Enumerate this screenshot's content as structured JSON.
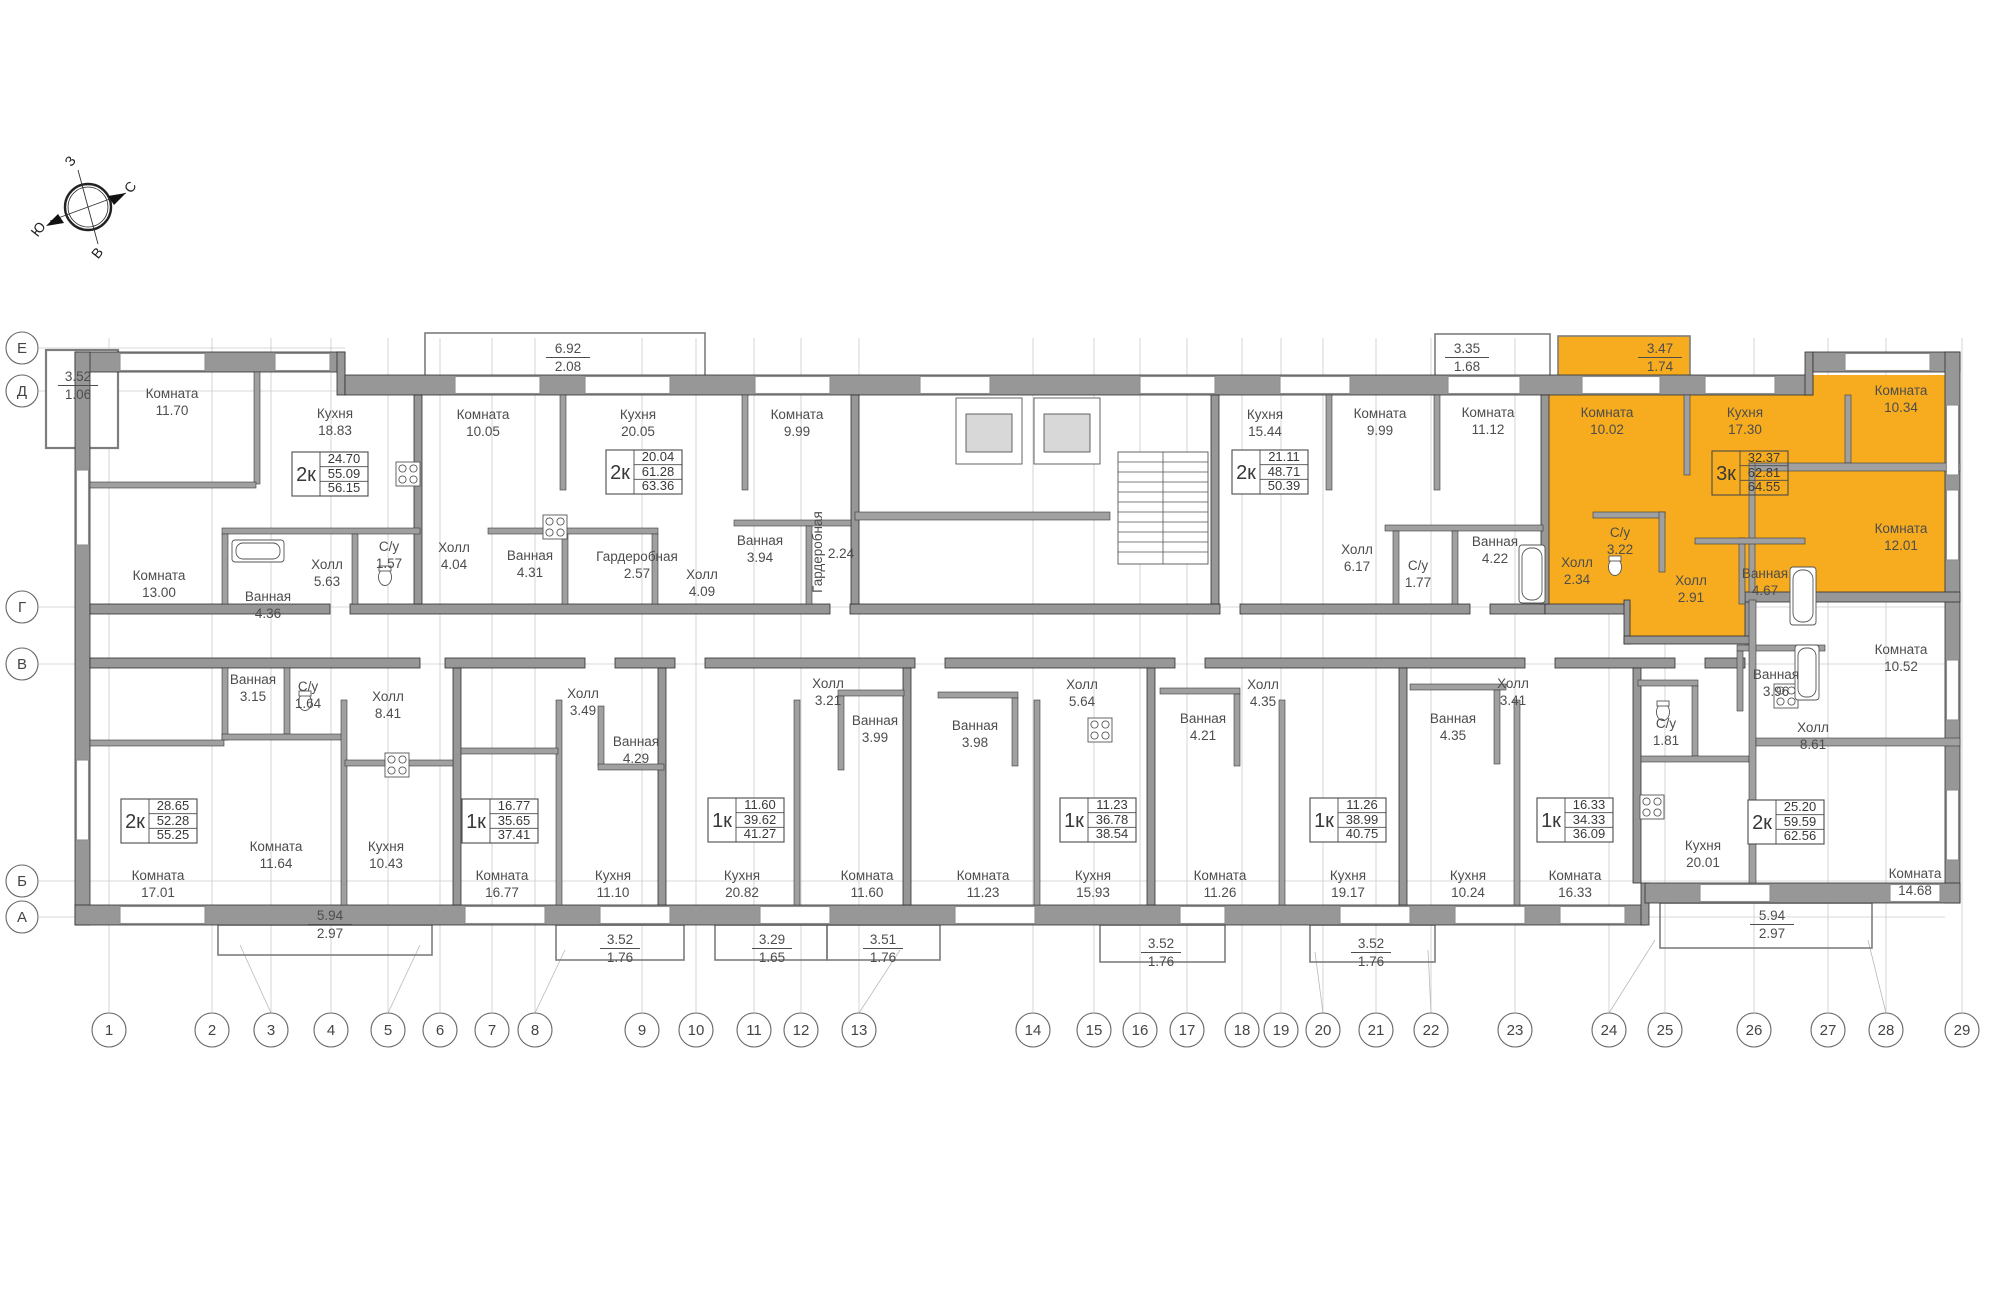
{
  "compass": {
    "top": "З",
    "right": "С",
    "bottom": "В",
    "left": "Ю"
  },
  "highlight": {
    "color": "#F6AC1E",
    "apartment_type": "3к"
  },
  "row_axes": [
    {
      "label": "Е"
    },
    {
      "label": "Д"
    },
    {
      "label": "Г"
    },
    {
      "label": "В"
    },
    {
      "label": "Б"
    },
    {
      "label": "А"
    }
  ],
  "column_axes": [
    {
      "label": "1"
    },
    {
      "label": "2"
    },
    {
      "label": "3"
    },
    {
      "label": "4"
    },
    {
      "label": "5"
    },
    {
      "label": "6"
    },
    {
      "label": "7"
    },
    {
      "label": "8"
    },
    {
      "label": "9"
    },
    {
      "label": "10"
    },
    {
      "label": "11"
    },
    {
      "label": "12"
    },
    {
      "label": "13"
    },
    {
      "label": "14"
    },
    {
      "label": "15"
    },
    {
      "label": "16"
    },
    {
      "label": "17"
    },
    {
      "label": "18"
    },
    {
      "label": "19"
    },
    {
      "label": "20"
    },
    {
      "label": "21"
    },
    {
      "label": "22"
    },
    {
      "label": "23"
    },
    {
      "label": "24"
    },
    {
      "label": "25"
    },
    {
      "label": "26"
    },
    {
      "label": "27"
    },
    {
      "label": "28"
    },
    {
      "label": "29"
    }
  ],
  "apartments": [
    {
      "type": "2к",
      "living_area": "24.70",
      "apartment_area": "55.09",
      "total_area": "56.15",
      "highlighted": false,
      "rooms": [
        {
          "name": "Комната",
          "area": "11.70"
        },
        {
          "name": "Кухня",
          "area": "18.83"
        },
        {
          "name": "Комната",
          "area": "13.00"
        },
        {
          "name": "Ванная",
          "area": "4.36"
        },
        {
          "name": "Холл",
          "area": "5.63"
        },
        {
          "name": "С/у",
          "area": "1.57"
        }
      ]
    },
    {
      "type": "2к",
      "living_area": "20.04",
      "apartment_area": "61.28",
      "total_area": "63.36",
      "highlighted": false,
      "rooms": [
        {
          "name": "Комната",
          "area": "10.05"
        },
        {
          "name": "Кухня",
          "area": "20.05"
        },
        {
          "name": "Комната",
          "area": "9.99"
        },
        {
          "name": "Холл",
          "area": "4.04"
        },
        {
          "name": "Ванная",
          "area": "4.31"
        },
        {
          "name": "Гардеробная",
          "area": "2.57"
        },
        {
          "name": "Холл",
          "area": "4.09"
        },
        {
          "name": "Ванная",
          "area": "3.94"
        },
        {
          "name": "Гардеробная",
          "area": "2.24"
        }
      ]
    },
    {
      "type": "2к",
      "living_area": "21.11",
      "apartment_area": "48.71",
      "total_area": "50.39",
      "highlighted": false,
      "rooms": [
        {
          "name": "Кухня",
          "area": "15.44"
        },
        {
          "name": "Комната",
          "area": "9.99"
        },
        {
          "name": "Комната",
          "area": "11.12"
        },
        {
          "name": "Холл",
          "area": "6.17"
        },
        {
          "name": "С/у",
          "area": "1.77"
        },
        {
          "name": "Ванная",
          "area": "4.22"
        }
      ]
    },
    {
      "type": "3к",
      "living_area": "32.37",
      "apartment_area": "62.81",
      "total_area": "64.55",
      "highlighted": true,
      "rooms": [
        {
          "name": "Комната",
          "area": "10.02"
        },
        {
          "name": "Кухня",
          "area": "17.30"
        },
        {
          "name": "Комната",
          "area": "10.34"
        },
        {
          "name": "Комната",
          "area": "12.01"
        },
        {
          "name": "Холл",
          "area": "2.34"
        },
        {
          "name": "С/у",
          "area": "3.22"
        },
        {
          "name": "Холл",
          "area": "2.91"
        },
        {
          "name": "Ванная",
          "area": "4.67"
        }
      ]
    },
    {
      "type": "2к",
      "living_area": "28.65",
      "apartment_area": "52.28",
      "total_area": "55.25",
      "highlighted": false,
      "rooms": [
        {
          "name": "Комната",
          "area": "17.01"
        },
        {
          "name": "Комната",
          "area": "11.64"
        },
        {
          "name": "Кухня",
          "area": "10.43"
        },
        {
          "name": "Ванная",
          "area": "3.15"
        },
        {
          "name": "С/у",
          "area": "1.64"
        },
        {
          "name": "Холл",
          "area": "8.41"
        }
      ]
    },
    {
      "type": "1к",
      "living_area": "16.77",
      "apartment_area": "35.65",
      "total_area": "37.41",
      "highlighted": false,
      "rooms": [
        {
          "name": "Комната",
          "area": "16.77"
        },
        {
          "name": "Кухня",
          "area": "11.10"
        },
        {
          "name": "Холл",
          "area": "3.49"
        },
        {
          "name": "Ванная",
          "area": "4.29"
        }
      ]
    },
    {
      "type": "1к",
      "living_area": "11.60",
      "apartment_area": "39.62",
      "total_area": "41.27",
      "highlighted": false,
      "rooms": [
        {
          "name": "Кухня",
          "area": "20.82"
        },
        {
          "name": "Комната",
          "area": "11.60"
        },
        {
          "name": "Холл",
          "area": "3.21"
        },
        {
          "name": "Ванная",
          "area": "3.99"
        }
      ]
    },
    {
      "type": "1к",
      "living_area": "11.23",
      "apartment_area": "36.78",
      "total_area": "38.54",
      "highlighted": false,
      "rooms": [
        {
          "name": "Комната",
          "area": "11.23"
        },
        {
          "name": "Кухня",
          "area": "15.93"
        },
        {
          "name": "Холл",
          "area": "5.64"
        },
        {
          "name": "Ванная",
          "area": "3.98"
        }
      ]
    },
    {
      "type": "1к",
      "living_area": "11.26",
      "apartment_area": "38.99",
      "total_area": "40.75",
      "highlighted": false,
      "rooms": [
        {
          "name": "Кухня",
          "area": "19.17"
        },
        {
          "name": "Комната",
          "area": "11.26"
        },
        {
          "name": "Холл",
          "area": "4.35"
        },
        {
          "name": "Ванная",
          "area": "4.21"
        }
      ]
    },
    {
      "type": "1к",
      "living_area": "16.33",
      "apartment_area": "34.33",
      "total_area": "36.09",
      "highlighted": false,
      "rooms": [
        {
          "name": "Кухня",
          "area": "10.24"
        },
        {
          "name": "Комната",
          "area": "16.33"
        },
        {
          "name": "Холл",
          "area": "3.41"
        },
        {
          "name": "Ванная",
          "area": "4.35"
        }
      ]
    },
    {
      "type": "2к",
      "living_area": "25.20",
      "apartment_area": "59.59",
      "total_area": "62.56",
      "highlighted": false,
      "rooms": [
        {
          "name": "Комната",
          "area": "10.52"
        },
        {
          "name": "Комната",
          "area": "14.68"
        },
        {
          "name": "Кухня",
          "area": "20.01"
        },
        {
          "name": "Холл",
          "area": "8.61"
        },
        {
          "name": "Ванная",
          "area": "3.96"
        },
        {
          "name": "С/у",
          "area": "1.81"
        }
      ]
    }
  ],
  "balconies": [
    {
      "area": "3.52",
      "reduced": "1.06",
      "highlighted": false
    },
    {
      "area": "6.92",
      "reduced": "2.08",
      "highlighted": false
    },
    {
      "area": "3.35",
      "reduced": "1.68",
      "highlighted": false
    },
    {
      "area": "3.47",
      "reduced": "1.74",
      "highlighted": true
    },
    {
      "area": "5.94",
      "reduced": "2.97",
      "highlighted": false
    },
    {
      "area": "3.52",
      "reduced": "1.76",
      "highlighted": false
    },
    {
      "area": "3.29",
      "reduced": "1.65",
      "highlighted": false
    },
    {
      "area": "3.51",
      "reduced": "1.76",
      "highlighted": false
    },
    {
      "area": "3.52",
      "reduced": "1.76",
      "highlighted": false
    },
    {
      "area": "3.52",
      "reduced": "1.76",
      "highlighted": false
    },
    {
      "area": "5.94",
      "reduced": "2.97",
      "highlighted": false
    }
  ]
}
